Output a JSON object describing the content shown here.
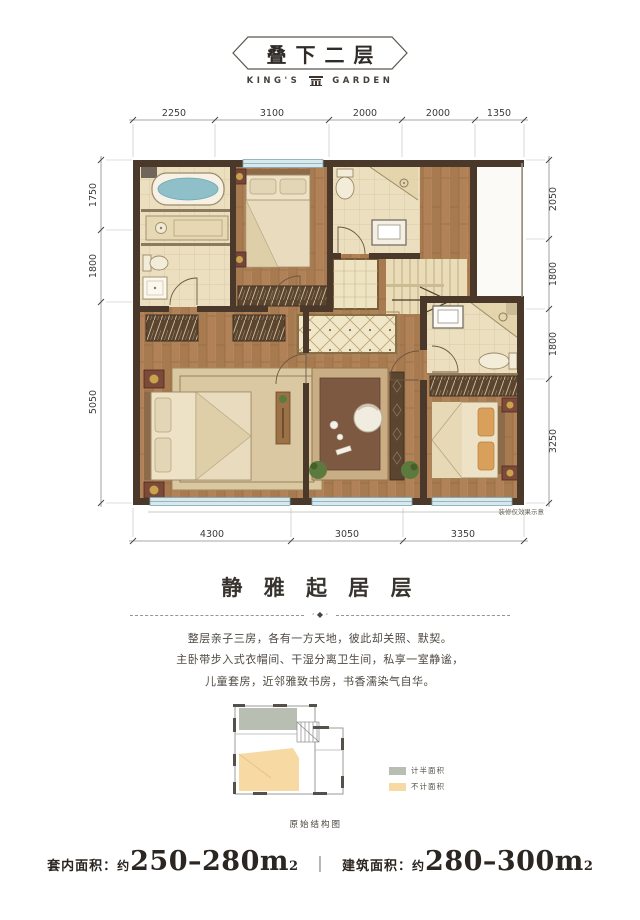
{
  "header": {
    "title": "叠下二层",
    "brand_prefix": "KING'S",
    "brand_suffix": "GARDEN"
  },
  "plan": {
    "dims_top": [
      "2250",
      "3100",
      "2000",
      "2000",
      "1350"
    ],
    "dims_bottom": [
      "4300",
      "3050",
      "3350"
    ],
    "dims_left": [
      "1750",
      "1800",
      "5050"
    ],
    "dims_right": [
      "2050",
      "1800",
      "1800",
      "3250"
    ],
    "note": "装修仅效果示意"
  },
  "section": {
    "title": "静 雅 起 居 层",
    "ornament": "· ◆ ·",
    "paragraph": [
      "整层亲子三房，各有一方天地，彼此却关照、默契。",
      "主卧带步入式衣帽间、干湿分离卫生间，私享一室静谧，",
      "儿童套房，近邻雅致书房，书香濡染气自华。"
    ]
  },
  "diagram": {
    "caption": "原始结构图",
    "legend": [
      {
        "label": "计半面积",
        "color": "#b9beb3"
      },
      {
        "label": "不计面积",
        "color": "#f7d9a4"
      }
    ]
  },
  "footer": {
    "item1_label": "套内面积：",
    "item1_approx": "约",
    "item1_value": "250–280m",
    "item1_sup": "2",
    "separator": "｜",
    "item2_label": "建筑面积：",
    "item2_approx": "约",
    "item2_value": "280–300m",
    "item2_sup": "2"
  },
  "colors": {
    "wall": "#4a392b",
    "wood": "#b18157",
    "tile": "#ebdfc0",
    "window": "#d7e9ed",
    "legend_gray": "#b9beb3",
    "legend_orange": "#f7d9a4"
  }
}
